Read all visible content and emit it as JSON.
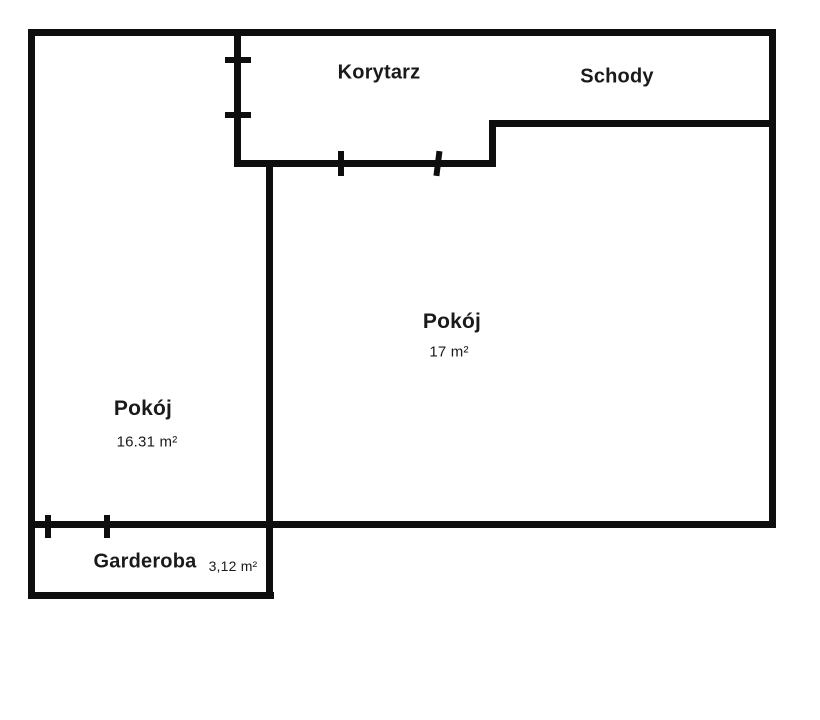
{
  "palette": {
    "background": "#ffffff",
    "wall_color": "#0e0e0e",
    "text_color": "#1a1a1a"
  },
  "floorplan": {
    "rooms": [
      {
        "id": "korytarz",
        "name": "Korytarz",
        "area": ""
      },
      {
        "id": "schody",
        "name": "Schody",
        "area": ""
      },
      {
        "id": "pokoj-main",
        "name": "Pokój",
        "area": "17 m²"
      },
      {
        "id": "pokoj-left",
        "name": "Pokój",
        "area": "16.31 m²"
      },
      {
        "id": "garderoba",
        "name": "Garderoba",
        "area": "3,12 m²"
      }
    ],
    "door_tick_count": 6
  }
}
